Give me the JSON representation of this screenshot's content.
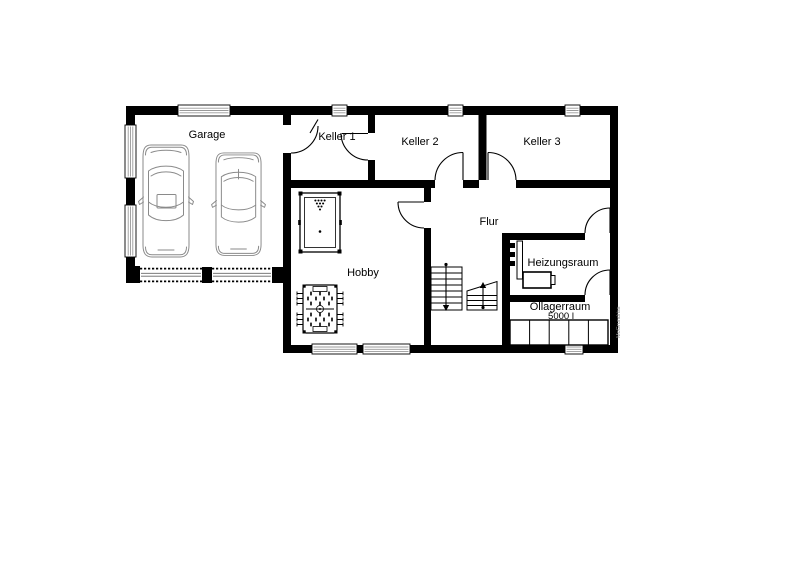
{
  "floorplan": {
    "rooms": [
      {
        "id": "garage",
        "label": "Garage"
      },
      {
        "id": "keller1",
        "label": "Keller 1"
      },
      {
        "id": "keller2",
        "label": "Keller 2"
      },
      {
        "id": "keller3",
        "label": "Keller 3"
      },
      {
        "id": "flur",
        "label": "Flur"
      },
      {
        "id": "hobby",
        "label": "Hobby"
      },
      {
        "id": "heizungsraum",
        "label": "Heizungsraum"
      },
      {
        "id": "oellagerraum",
        "label": "Öllagerraum",
        "capacity": "5000 l"
      }
    ],
    "watermark": "MoGrundriss",
    "colors": {
      "wall": "#000000",
      "background": "#ffffff",
      "window_stripe": "#999999",
      "car_line": "#8a8a8a",
      "watermark_text": "#8c8c8c"
    },
    "symbols": [
      "car-icon",
      "car-icon",
      "billiard-table-icon",
      "foosball-table-icon",
      "staircase-down-icon",
      "staircase-up-icon",
      "boiler-icon",
      "pipe-icon",
      "oil-tanks-icon",
      "door-swing-icon",
      "window-icon",
      "garage-door-icon"
    ]
  }
}
